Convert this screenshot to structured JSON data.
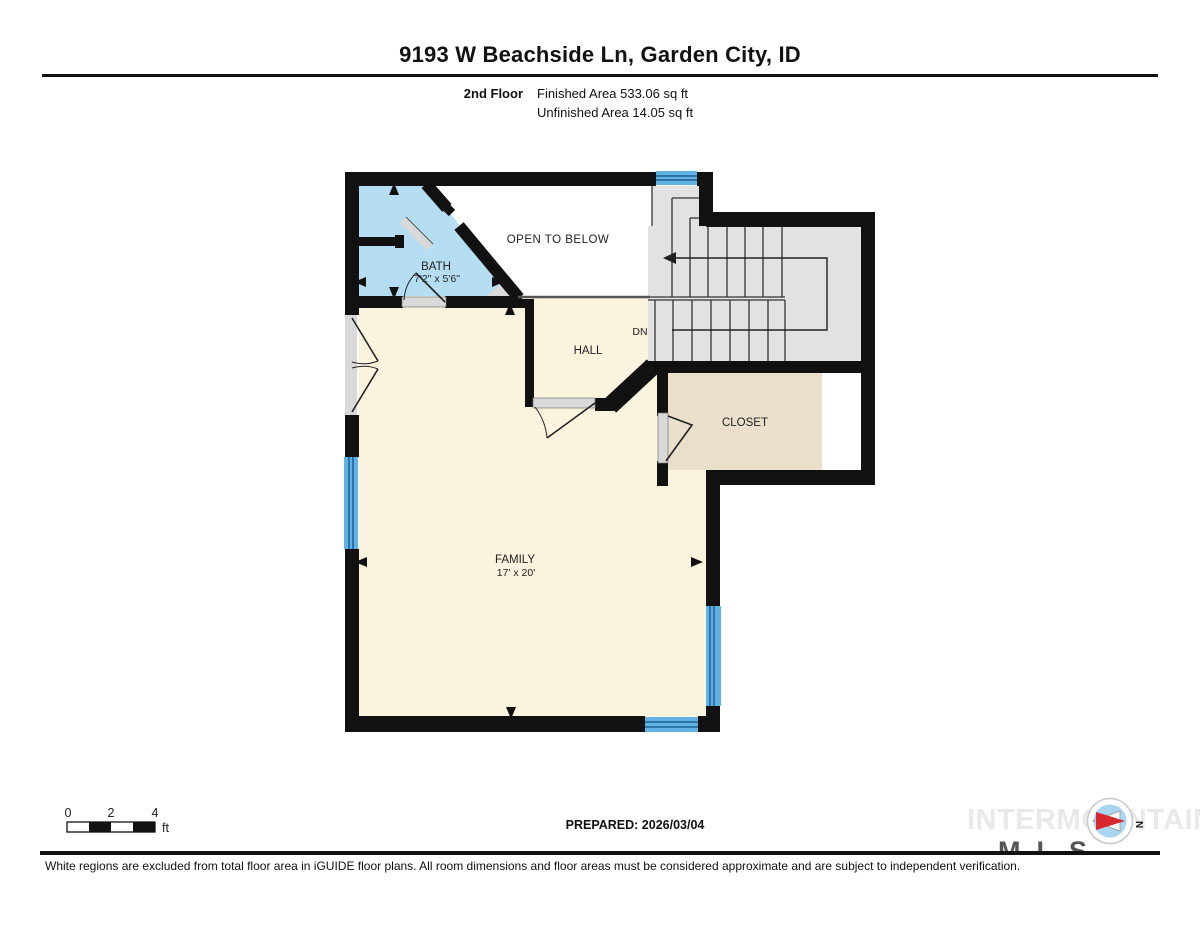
{
  "header": {
    "title": "9193 W Beachside Ln, Garden City, ID",
    "floor_label": "2nd Floor",
    "finished_area": "Finished Area 533.06 sq ft",
    "unfinished_area": "Unfinished Area 14.05 sq ft"
  },
  "floor_plan": {
    "rooms": {
      "bath": {
        "name": "BATH",
        "dims": "7'2\" x 5'6\""
      },
      "open_below": {
        "name": "OPEN TO BELOW"
      },
      "hall": {
        "name": "HALL"
      },
      "stairs": {
        "direction_label": "DN"
      },
      "closet": {
        "name": "CLOSET"
      },
      "family": {
        "name": "FAMILY",
        "dims": "17' x 20'"
      }
    },
    "colors": {
      "wall": "#111111",
      "floor": "#faf3dd",
      "bath": "#b5def3",
      "closet": "#e9dfca",
      "stairs": "#e2e2e2",
      "window": "#5fb2e2",
      "window_line": "#1f5f96",
      "door": "#d9d9d9",
      "open_below": "#ffffff"
    }
  },
  "scale_bar": {
    "ticks": [
      "0",
      "2",
      "4"
    ],
    "unit": "ft"
  },
  "compass": {
    "north_label": "N"
  },
  "footer": {
    "prepared": "PREPARED: 2026/03/04",
    "watermark": "INTERMOUNTAIN",
    "watermark_sub": "MLS",
    "disclaimer": "White regions are excluded from total floor area in iGUIDE floor plans. All room dimensions and floor areas must be considered approximate and are subject to independent verification."
  }
}
